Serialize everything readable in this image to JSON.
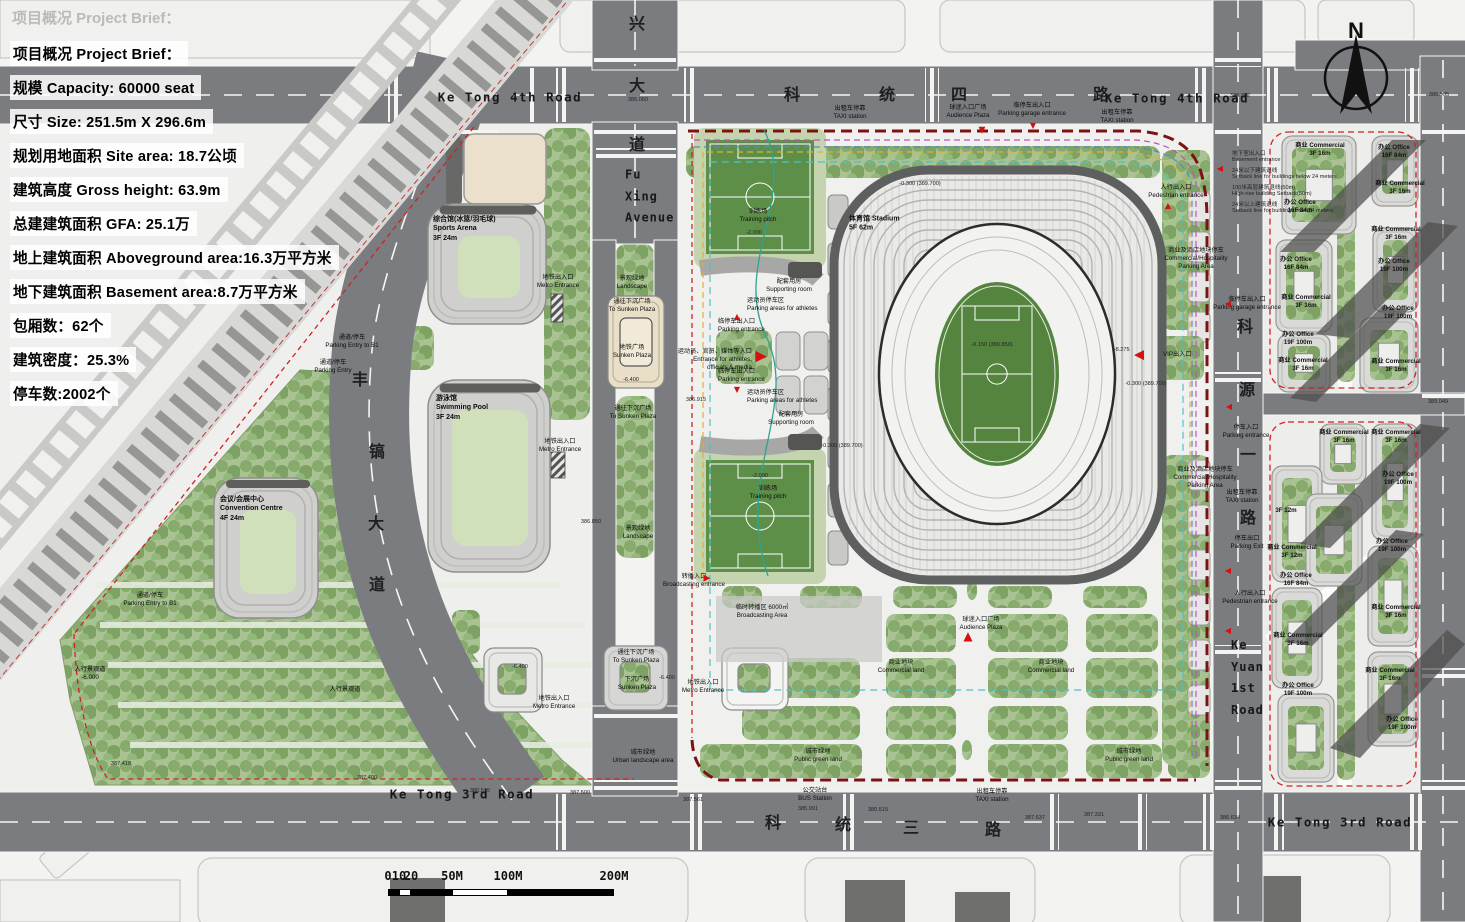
{
  "palette": {
    "road": "#7a7c7f",
    "paper": "#f3f3f2",
    "paving": "#f0f0ee",
    "green": "#8fb478",
    "field_green": "#55843f",
    "boundary_red": "#d02222",
    "boundary_maroon": "#7c1215",
    "accent_red": "#d60f12",
    "shadow": "#4d4d4d",
    "cream": "#e9dfc9"
  },
  "project_brief": {
    "watermark": "项目概况 Project Brief：",
    "lines": [
      "项目概况 Project Brief：",
      "规模 Capacity: 60000 seat",
      "尺寸 Size: 251.5m X 296.6m",
      "规划用地面积 Site area: 18.7公顷",
      "建筑高度 Gross height: 63.9m",
      "总建建筑面积 GFA: 25.1万",
      "地上建筑面积 Aboveground area:16.3万平方米",
      "地下建筑面积 Basement area:8.7万平方米",
      "包厢数：62个",
      "建筑密度：25.3%",
      "停车数:2002个"
    ]
  },
  "north_arrow": {
    "label": "N"
  },
  "scale_bar": {
    "ticks": [
      {
        "label": "0",
        "x": 388
      },
      {
        "label": "10",
        "x": 399
      },
      {
        "label": "20",
        "x": 411
      },
      {
        "label": "50M",
        "x": 452
      },
      {
        "label": "100M",
        "x": 508
      },
      {
        "label": "200M",
        "x": 614
      }
    ],
    "segments": [
      [
        388,
        399,
        1
      ],
      [
        399,
        411,
        0
      ],
      [
        411,
        452,
        1
      ],
      [
        452,
        508,
        0
      ],
      [
        508,
        614,
        1
      ]
    ]
  },
  "map_labels": [
    {
      "t": "兴",
      "x": 637,
      "y": 22,
      "k": "rc"
    },
    {
      "t": "大",
      "x": 637,
      "y": 84,
      "k": "rc"
    },
    {
      "t": "道",
      "x": 637,
      "y": 143,
      "k": "rc"
    },
    {
      "t": "科",
      "x": 792,
      "y": 93,
      "k": "rc"
    },
    {
      "t": "统",
      "x": 887,
      "y": 93,
      "k": "rc"
    },
    {
      "t": "四",
      "x": 959,
      "y": 93,
      "k": "rc"
    },
    {
      "t": "路",
      "x": 1101,
      "y": 93,
      "k": "rc"
    },
    {
      "t": "Ke Tong 4th Road",
      "x": 510,
      "y": 97,
      "k": "rn"
    },
    {
      "t": "Ke Tong 4th Road",
      "x": 1177,
      "y": 98,
      "k": "rn"
    },
    {
      "t": "丰",
      "x": 360,
      "y": 378,
      "k": "rc"
    },
    {
      "t": "镐",
      "x": 377,
      "y": 450,
      "k": "rc"
    },
    {
      "t": "大",
      "x": 376,
      "y": 522,
      "k": "rc"
    },
    {
      "t": "道",
      "x": 377,
      "y": 583,
      "k": "rc"
    },
    {
      "t": "科",
      "x": 1245,
      "y": 325,
      "k": "rc"
    },
    {
      "t": "源",
      "x": 1247,
      "y": 388,
      "k": "rc"
    },
    {
      "t": "一",
      "x": 1248,
      "y": 453,
      "k": "rc"
    },
    {
      "t": "路",
      "x": 1248,
      "y": 516,
      "k": "rc"
    },
    {
      "t": "科",
      "x": 773,
      "y": 821,
      "k": "rc"
    },
    {
      "t": "统",
      "x": 843,
      "y": 823,
      "k": "rc"
    },
    {
      "t": "三",
      "x": 911,
      "y": 826,
      "k": "rc"
    },
    {
      "t": "路",
      "x": 993,
      "y": 828,
      "k": "rc"
    },
    {
      "t": "Ke Tong 3rd Road",
      "x": 462,
      "y": 794,
      "k": "rn"
    },
    {
      "t": "Ke Tong 3rd Road",
      "x": 1340,
      "y": 822,
      "k": "rn"
    },
    {
      "t": "Fu\nXing\nAvenue",
      "x": 625,
      "y": 197,
      "k": "an",
      "a": "l"
    },
    {
      "t": "Ke\nYuan\n1st\nRoad",
      "x": 1231,
      "y": 678,
      "k": "an",
      "a": "l"
    },
    {
      "t": "综合馆(冰篮/羽毛球)\nSports Arena\n3F 24m",
      "x": 433,
      "y": 229,
      "k": "bl",
      "a": "l"
    },
    {
      "t": "游泳馆\nSwimming Pool\n3F 24m",
      "x": 436,
      "y": 408,
      "k": "bl",
      "a": "l"
    },
    {
      "t": "会议/会展中心\nConvention Centre\n4F 24m",
      "x": 220,
      "y": 509,
      "k": "bl",
      "a": "l"
    },
    {
      "t": "体育馆 Stadium\n5F 62m",
      "x": 849,
      "y": 224,
      "k": "bl",
      "a": "l"
    },
    {
      "t": "景观绿地\nLandscape",
      "x": 632,
      "y": 283,
      "k": "tl"
    },
    {
      "t": "通往下沉广场\nTo Sunken Plaza",
      "x": 632,
      "y": 306,
      "k": "tl"
    },
    {
      "t": "地铁广场\nSunken Plaza",
      "x": 632,
      "y": 352,
      "k": "tl"
    },
    {
      "t": "-6.400",
      "x": 631,
      "y": 380,
      "k": "el"
    },
    {
      "t": "通往下沉广场\nTo Sunken Plaza",
      "x": 633,
      "y": 413,
      "k": "tl"
    },
    {
      "t": "景观绿地\nLandscape",
      "x": 638,
      "y": 533,
      "k": "tl"
    },
    {
      "t": "通往下沉广场\nTo Sunken Plaza",
      "x": 636,
      "y": 657,
      "k": "tl"
    },
    {
      "t": "下沉广场\nSunken Plaza",
      "x": 637,
      "y": 684,
      "k": "tl"
    },
    {
      "t": "-6.400",
      "x": 667,
      "y": 678,
      "k": "el"
    },
    {
      "t": "城市绿地\nUrban landscape area",
      "x": 643,
      "y": 757,
      "k": "tl"
    },
    {
      "t": "-6.400",
      "x": 520,
      "y": 667,
      "k": "el"
    },
    {
      "t": "地铁出入口\nMetro Entrance",
      "x": 558,
      "y": 282,
      "k": "tl"
    },
    {
      "t": "地铁出入口\nMetro Entrance",
      "x": 560,
      "y": 446,
      "k": "tl"
    },
    {
      "t": "地铁出入口\nMetro Entrance",
      "x": 554,
      "y": 703,
      "k": "tl"
    },
    {
      "t": "地铁出入口\nMetro Entrance",
      "x": 703,
      "y": 687,
      "k": "tl"
    },
    {
      "t": "通道/停车\nParking Entry to B1",
      "x": 352,
      "y": 342,
      "k": "tl"
    },
    {
      "t": "通道/停车\nParking Entry",
      "x": 333,
      "y": 367,
      "k": "tl"
    },
    {
      "t": "通道/停车\nParking Entry to B1",
      "x": 150,
      "y": 600,
      "k": "tl"
    },
    {
      "t": "人行景观道\n-6.000",
      "x": 90,
      "y": 674,
      "k": "tl"
    },
    {
      "t": "人行景观道",
      "x": 345,
      "y": 690,
      "k": "tl"
    },
    {
      "t": "训练场\nTraining pitch",
      "x": 758,
      "y": 216,
      "k": "tl"
    },
    {
      "t": "-2.000",
      "x": 754,
      "y": 233,
      "k": "el"
    },
    {
      "t": "训练场\nTraining pitch",
      "x": 768,
      "y": 493,
      "k": "tl"
    },
    {
      "t": "-2.000",
      "x": 760,
      "y": 476,
      "k": "el"
    },
    {
      "t": "配套用房\nSupporting room",
      "x": 789,
      "y": 286,
      "k": "tl"
    },
    {
      "t": "配套用房\nSupporting room",
      "x": 791,
      "y": 419,
      "k": "tl"
    },
    {
      "t": "运动员停车区\nParking areas for athletes",
      "x": 747,
      "y": 305,
      "k": "tl",
      "a": "l"
    },
    {
      "t": "运动员停车区\nParking areas for athletes",
      "x": 747,
      "y": 397,
      "k": "tl",
      "a": "l"
    },
    {
      "t": "临停车出入口\nParking entrance",
      "x": 718,
      "y": 326,
      "k": "tl",
      "a": "l"
    },
    {
      "t": "临停车出入口\nParking entrance",
      "x": 718,
      "y": 376,
      "k": "tl",
      "a": "l"
    },
    {
      "t": "运动员、官员、媒体等入口\nEntrance for athletes,\nofficials & media",
      "x": 752,
      "y": 360,
      "k": "tl",
      "a": "r"
    },
    {
      "t": "球迷入口广场\nAudience Plaza",
      "x": 968,
      "y": 112,
      "k": "tl"
    },
    {
      "t": "临停车出入口\nParking garage entrance",
      "x": 1032,
      "y": 110,
      "k": "tl"
    },
    {
      "t": "出租车停靠\nTAXI station",
      "x": 850,
      "y": 113,
      "k": "tl"
    },
    {
      "t": "出租车停靠\nTAXI station",
      "x": 1117,
      "y": 117,
      "k": "tl"
    },
    {
      "t": "人行出入口\nPedestrian entrance",
      "x": 1176,
      "y": 192,
      "k": "tl"
    },
    {
      "t": "地下室出入口\nBasement entrance",
      "x": 1232,
      "y": 156,
      "k": "el",
      "a": "l"
    },
    {
      "t": "24米以下建筑退线\nSetback line for buildings below 24 meters",
      "x": 1232,
      "y": 173,
      "k": "el",
      "a": "l"
    },
    {
      "t": "100米高层建筑退线(50m)\nHigh-rise building Setback(50m)",
      "x": 1232,
      "y": 190,
      "k": "el",
      "a": "l"
    },
    {
      "t": "24米以上建筑退线\nSetback line for buildings over 24 meters",
      "x": 1232,
      "y": 207,
      "k": "el",
      "a": "l"
    },
    {
      "t": "商业及酒店地块停车\nCommercial/Hospitality\nParking Area",
      "x": 1196,
      "y": 259,
      "k": "tl"
    },
    {
      "t": "商业及酒店地块停车\nCommercial/Hospitality\nParking Area",
      "x": 1205,
      "y": 478,
      "k": "tl"
    },
    {
      "t": "临停车出入口\nParking garage entrance",
      "x": 1247,
      "y": 304,
      "k": "tl"
    },
    {
      "t": "停车入口\nParking entrance",
      "x": 1246,
      "y": 432,
      "k": "tl"
    },
    {
      "t": "出租车停靠\nTAXI station",
      "x": 1242,
      "y": 497,
      "k": "tl"
    },
    {
      "t": "停车出口\nParking Exit",
      "x": 1247,
      "y": 543,
      "k": "tl"
    },
    {
      "t": "人行出入口\nPedestrian entrance",
      "x": 1250,
      "y": 598,
      "k": "tl"
    },
    {
      "t": "+8.275",
      "x": 1121,
      "y": 350,
      "k": "el"
    },
    {
      "t": "VIP出入口",
      "x": 1163,
      "y": 355,
      "k": "tl",
      "a": "l"
    },
    {
      "t": "临时转播区 6000㎡\nBroadcasting Area",
      "x": 762,
      "y": 612,
      "k": "tl"
    },
    {
      "t": "转播入口\nBroadcasting entrance",
      "x": 694,
      "y": 581,
      "k": "tl"
    },
    {
      "t": "球迷入口广场\nAudience Plaza",
      "x": 981,
      "y": 624,
      "k": "tl"
    },
    {
      "t": "商业地块\nCommercial land",
      "x": 901,
      "y": 667,
      "k": "tl"
    },
    {
      "t": "商业地块\nCommercial land",
      "x": 1051,
      "y": 667,
      "k": "tl"
    },
    {
      "t": "城市绿地\nPublic green land",
      "x": 818,
      "y": 756,
      "k": "tl"
    },
    {
      "t": "城市绿地\nPublic green land",
      "x": 1129,
      "y": 756,
      "k": "tl"
    },
    {
      "t": "公交站台\nBUS Station",
      "x": 815,
      "y": 795,
      "k": "tl"
    },
    {
      "t": "出租车停靠\nTAXI station",
      "x": 992,
      "y": 796,
      "k": "tl"
    },
    {
      "t": "商业 Commercial\n3F 16m",
      "x": 1320,
      "y": 150,
      "k": "bl6"
    },
    {
      "t": "办公 Office\n16F 84m",
      "x": 1300,
      "y": 207,
      "k": "bl6"
    },
    {
      "t": "办公 Office\n16F 84m",
      "x": 1394,
      "y": 152,
      "k": "bl6"
    },
    {
      "t": "商业 Commercial\n3F 16m",
      "x": 1400,
      "y": 188,
      "k": "bl6"
    },
    {
      "t": "办公 Office\n16F 84m",
      "x": 1296,
      "y": 264,
      "k": "bl6"
    },
    {
      "t": "商业 Commercial\n3F 16m",
      "x": 1306,
      "y": 302,
      "k": "bl6"
    },
    {
      "t": "商业 Commercial\n3F 16m",
      "x": 1396,
      "y": 234,
      "k": "bl6"
    },
    {
      "t": "办公 Office\n19F 100m",
      "x": 1394,
      "y": 266,
      "k": "bl6"
    },
    {
      "t": "办公 Office\n19F 100m",
      "x": 1298,
      "y": 339,
      "k": "bl6"
    },
    {
      "t": "商业 Commercial\n3F 16m",
      "x": 1303,
      "y": 365,
      "k": "bl6"
    },
    {
      "t": "办公 Office\n19F 100m",
      "x": 1398,
      "y": 313,
      "k": "bl6"
    },
    {
      "t": "商业 Commercial\n3F 16m",
      "x": 1396,
      "y": 366,
      "k": "bl6"
    },
    {
      "t": "商业 Commercial\n3F 16m",
      "x": 1344,
      "y": 437,
      "k": "bl6"
    },
    {
      "t": "商业 Commercial\n3F 16m",
      "x": 1396,
      "y": 437,
      "k": "bl6"
    },
    {
      "t": "办公 Office\n19F 100m",
      "x": 1398,
      "y": 479,
      "k": "bl6"
    },
    {
      "t": "3F 12m",
      "x": 1286,
      "y": 511,
      "k": "bl6"
    },
    {
      "t": "商业 Commercial\n3F 12m",
      "x": 1292,
      "y": 552,
      "k": "bl6"
    },
    {
      "t": "办公 Office\n16F 84m",
      "x": 1296,
      "y": 580,
      "k": "bl6"
    },
    {
      "t": "办公 Office\n19F 100m",
      "x": 1392,
      "y": 546,
      "k": "bl6"
    },
    {
      "t": "商业 Commercial\n3F 16m",
      "x": 1396,
      "y": 612,
      "k": "bl6"
    },
    {
      "t": "商业 Commercial\n3F 16m",
      "x": 1298,
      "y": 640,
      "k": "bl6"
    },
    {
      "t": "办公 Office\n19F 100m",
      "x": 1298,
      "y": 690,
      "k": "bl6"
    },
    {
      "t": "商业 Commercial\n3F 16m",
      "x": 1390,
      "y": 675,
      "k": "bl6"
    },
    {
      "t": "办公 Office\n19F 100m",
      "x": 1402,
      "y": 724,
      "k": "bl6"
    },
    {
      "t": "386.060",
      "x": 638,
      "y": 100,
      "k": "el"
    },
    {
      "t": "386.915",
      "x": 696,
      "y": 400,
      "k": "el"
    },
    {
      "t": "386.850",
      "x": 591,
      "y": 522,
      "k": "el"
    },
    {
      "t": "387.418",
      "x": 121,
      "y": 764,
      "k": "el"
    },
    {
      "t": "387.400",
      "x": 367,
      "y": 778,
      "k": "el"
    },
    {
      "t": "380.515",
      "x": 480,
      "y": 791,
      "k": "el"
    },
    {
      "t": "387.500",
      "x": 580,
      "y": 793,
      "k": "el"
    },
    {
      "t": "387.561",
      "x": 693,
      "y": 800,
      "k": "el"
    },
    {
      "t": "385.991",
      "x": 808,
      "y": 809,
      "k": "el"
    },
    {
      "t": "380.515",
      "x": 878,
      "y": 810,
      "k": "el"
    },
    {
      "t": "387.637",
      "x": 1035,
      "y": 818,
      "k": "el"
    },
    {
      "t": "387.331",
      "x": 1094,
      "y": 815,
      "k": "el"
    },
    {
      "t": "386.634",
      "x": 1230,
      "y": 818,
      "k": "el"
    },
    {
      "t": "386.362",
      "x": 1240,
      "y": 96,
      "k": "el"
    },
    {
      "t": "386.905",
      "x": 1439,
      "y": 95,
      "k": "el"
    },
    {
      "t": "389.049",
      "x": 1438,
      "y": 402,
      "k": "el"
    },
    {
      "t": "-0.300 (389.700)",
      "x": 920,
      "y": 184,
      "k": "el"
    },
    {
      "t": "-0.300 (389.700)",
      "x": 842,
      "y": 446,
      "k": "el"
    },
    {
      "t": "-0.300 (389.700)",
      "x": 1146,
      "y": 384,
      "k": "el"
    },
    {
      "t": "-0.150 (389.850)",
      "x": 992,
      "y": 345,
      "k": "el"
    }
  ],
  "markers": [
    {
      "g": "▼",
      "x": 982,
      "y": 131,
      "s": 9
    },
    {
      "g": "▼",
      "x": 1033,
      "y": 126,
      "s": 8
    },
    {
      "g": "▲",
      "x": 968,
      "y": 636,
      "s": 12
    },
    {
      "g": "▶",
      "x": 761,
      "y": 356,
      "s": 15
    },
    {
      "g": "▶",
      "x": 707,
      "y": 579,
      "s": 9
    },
    {
      "g": "▲",
      "x": 737,
      "y": 317,
      "s": 8
    },
    {
      "g": "▼",
      "x": 737,
      "y": 390,
      "s": 8
    },
    {
      "g": "◀",
      "x": 1139,
      "y": 355,
      "s": 13
    },
    {
      "g": "◀",
      "x": 1220,
      "y": 169,
      "s": 8
    },
    {
      "g": "◀",
      "x": 1228,
      "y": 304,
      "s": 8
    },
    {
      "g": "◀",
      "x": 1229,
      "y": 407,
      "s": 8
    },
    {
      "g": "◀",
      "x": 1228,
      "y": 571,
      "s": 8
    },
    {
      "g": "◀",
      "x": 1228,
      "y": 631,
      "s": 8
    },
    {
      "g": "▲",
      "x": 1168,
      "y": 206,
      "s": 8
    }
  ]
}
